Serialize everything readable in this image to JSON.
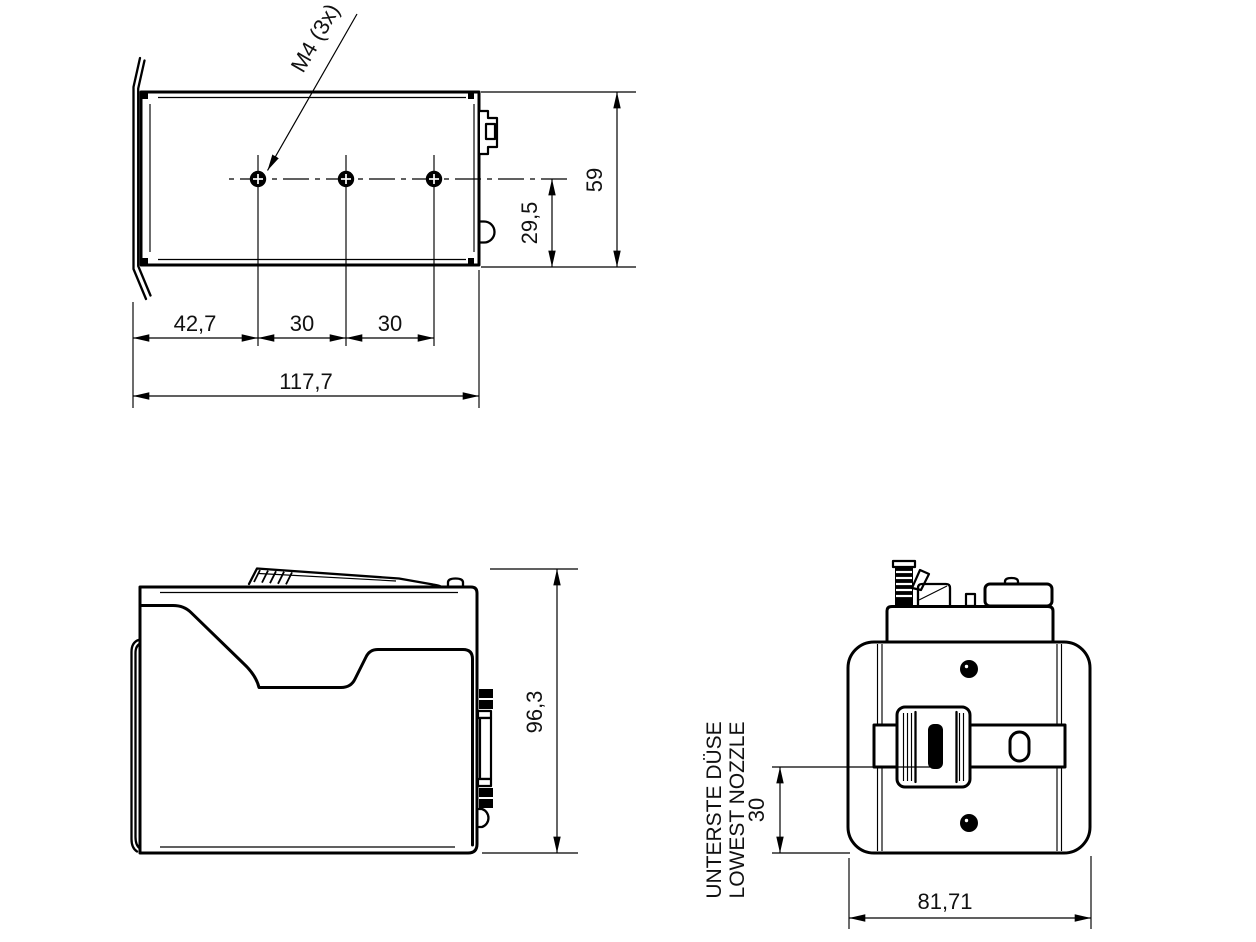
{
  "drawing": {
    "background": "#ffffff",
    "line_color": "#000000",
    "views": {
      "top": {
        "thread_callout": "M4 (3x)",
        "dims": {
          "hole_offset_left": "42,7",
          "hole_pitch_1": "30",
          "hole_pitch_2": "30",
          "total_width": "117,7",
          "center_to_bottom": "29,5",
          "total_depth": "59"
        }
      },
      "side": {
        "dims": {
          "total_height": "96,3"
        }
      },
      "front": {
        "annotation": {
          "line1": "UNTERSTE DÜSE",
          "line2": "LOWEST NOZZLE"
        },
        "dims": {
          "lowest_nozzle_height": "30",
          "total_width": "81,71"
        }
      }
    }
  }
}
